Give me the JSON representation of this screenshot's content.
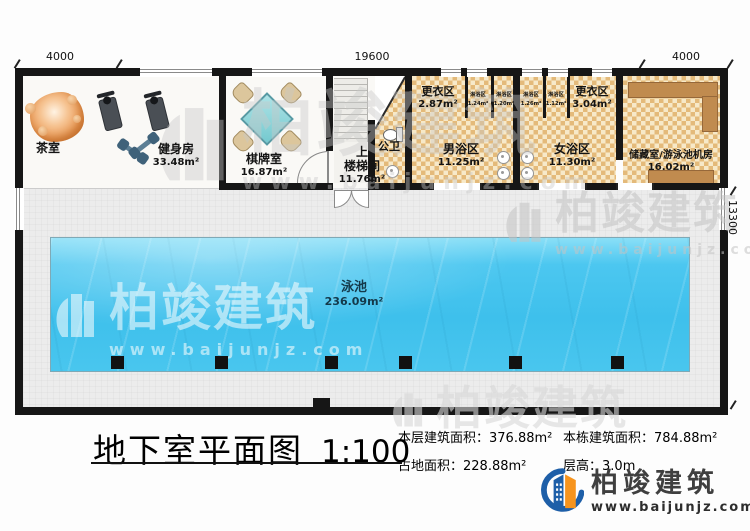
{
  "plan": {
    "dimensions": {
      "top_left": "4000",
      "top_center": "19600",
      "top_right": "4000",
      "right_side": "13300"
    },
    "rooms": {
      "tea": {
        "name": "茶室"
      },
      "gym": {
        "name": "健身房",
        "area": "33.48m²"
      },
      "chess": {
        "name": "棋牌室",
        "area": "16.87m²"
      },
      "stair": {
        "up": "上",
        "name": "楼梯间",
        "area": "11.76m²"
      },
      "toilet": {
        "name": "公卫"
      },
      "changing_left": {
        "name": "更衣区",
        "area": "2.87m²"
      },
      "men_bath": {
        "name": "男浴区",
        "area": "11.25m²"
      },
      "women_bath": {
        "name": "女浴区",
        "area": "11.30m²"
      },
      "changing_right": {
        "name": "更衣区",
        "area": "3.04m²"
      },
      "storage": {
        "name": "储藏室/游泳池机房",
        "area": "16.02m²"
      },
      "pool": {
        "name": "泳池",
        "area": "236.09m²"
      }
    },
    "showers": [
      {
        "name": "淋浴区",
        "area": "1.24m²"
      },
      {
        "name": "淋浴区",
        "area": "1.20m²"
      },
      {
        "name": "淋浴区",
        "area": "1.26m²"
      },
      {
        "name": "淋浴区",
        "area": "1.12m²"
      }
    ]
  },
  "title_block": {
    "title": "地下室平面图",
    "scale": "1:100",
    "stats": [
      {
        "label": "本层建筑面积：",
        "value": "376.88m²"
      },
      {
        "label": "本栋建筑面积：",
        "value": "784.88m²"
      },
      {
        "label": "占地面积：",
        "value": "228.88m²"
      },
      {
        "label": "层高：",
        "value": "3.0m"
      }
    ]
  },
  "brand": {
    "name": "柏竣建筑",
    "url": "www.baijunjz.com"
  },
  "watermark": {
    "name": "柏竣建筑",
    "url": "www.baijunjz.com"
  },
  "colors": {
    "wall": "#161616",
    "pool": "#41c3ee",
    "checker_dark": "#e4ba7a",
    "checker_light": "#f7e9c9",
    "brand_blue": "#1e5fa8",
    "brand_orange": "#f7941d"
  }
}
